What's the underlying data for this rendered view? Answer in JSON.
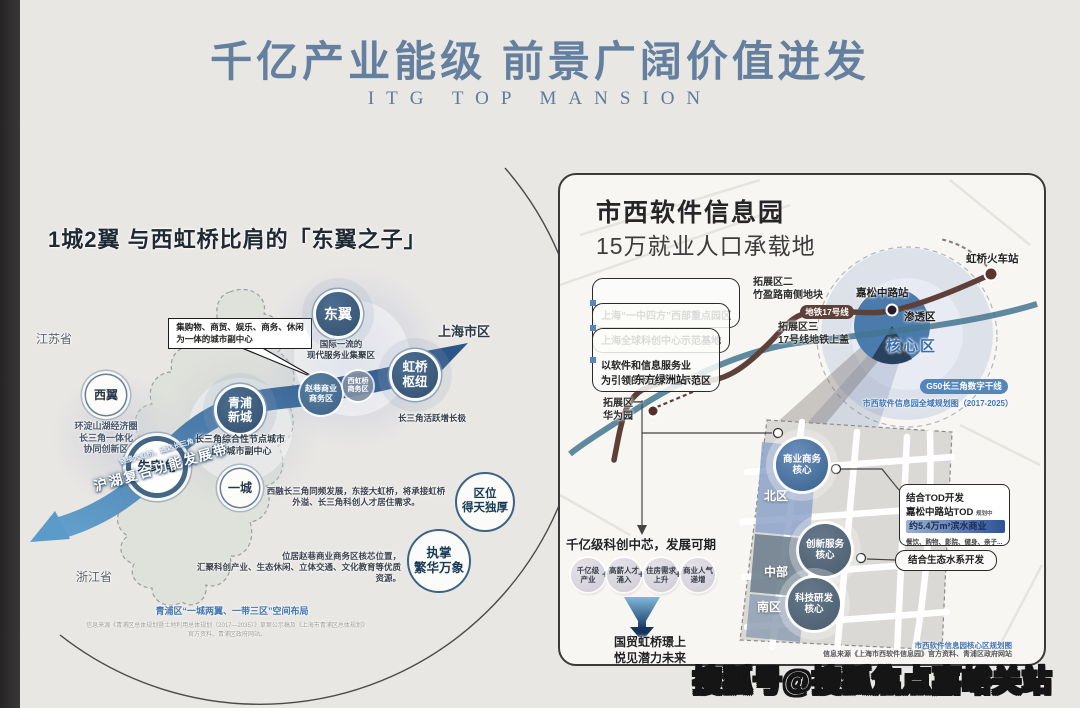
{
  "header": {
    "title": "千亿产业能级  前景广阔价值迸发",
    "subtitle": "ITG TOP MANSION"
  },
  "left_panel": {
    "title": "1城2翼 与西虹桥比肩的「东翼之子」",
    "jiangsu": "江苏省",
    "zhejiang": "浙江省",
    "shanghai": "上海市区",
    "callout": "集购物、商贸、娱乐、商务、休闲\n为一体的城市副中心",
    "west_wing": "西翼",
    "west_wing_desc": "环淀山湖经济圈\n长三角一体化\n协同创新区",
    "zhujiajiao": "朱家角",
    "qingpu": "青浦\n新城",
    "qingpu_desc": "长三角综合性节点城市\n上海城市副中心",
    "one_city": "一城",
    "east_wing": "东翼",
    "east_wing_desc": "国际一流的\n现代服务业集聚区",
    "zhaoxiang": "赵巷商业\n商务区",
    "west_hongqiao": "西虹桥\n商务区",
    "hongqiao_hub": "虹桥\n枢纽",
    "hongqiao_desc": "长三角活跃增长极",
    "ribbon_small": "链接大虹桥，通达长三角",
    "ribbon_label": "沪湖复合功能发展带",
    "desc1": "西融长三角同频发展，东接大虹桥，将承接虹桥\n外溢、长三角科创人才居住需求。",
    "desc2": "位居赵巷商业商务区核芯位置，\n汇聚科创产业、生态休闲、立体交通、文化教育等优质资源。",
    "badge_location": "区位\n得天独厚",
    "badge_prosperity": "执掌\n繁华万象",
    "caption": "青浦区“一城两翼、一带三区”空间布局",
    "source": "信息来源《青浦区总体规划暨土地利用总体规划（2017—2035）》草案公示稿及《上海市青浦区总体规划》\n官方资料、青浦区政府网站。"
  },
  "right_panel": {
    "title": "市西软件信息园",
    "subtitle": "15万就业人口承载地",
    "bullets": [
      "上海“一中四方”西部重点园区",
      "上海全球科创中心示范基地",
      "以软件和信息服务业\n为引领的科创产业示范区"
    ],
    "map": {
      "expansion2": "拓展区二\n竹盈路南侧地块",
      "metro_badge": "地铁17号线",
      "expansion3": "拓展区三\n17号线地铁上盖",
      "station_jiasong": "嘉松中路站",
      "zone_penetration": "渗透区",
      "zone_core": "核心区",
      "station_hongqiao": "虹桥火车站",
      "station_dongfang": "东方绿洲站",
      "expansion1": "拓展区一\n华为园",
      "g50_badge": "G50长三角数字干线",
      "plan_caption": "市西软件信息园全域规划图（2017-2025）",
      "district_north": "北区",
      "district_mid": "中部",
      "district_south": "南区",
      "core_business": "商业商务\n核心",
      "core_innovation": "创新服务\n核心",
      "core_tech": "科技研发\n核心",
      "tod_title": "结合TOD开发",
      "tod_line2": "嘉松中路站TOD",
      "tod_note": "规划中",
      "tod_highlight": "约5.4万m²滨水商业",
      "tod_desc": "餐饮、购物、影院、健身、亲子...",
      "eco_callout": "结合生态水系开发"
    },
    "bottom": {
      "headline": "千亿级科创中芯，发展可期",
      "factors": [
        "千亿级\n产业",
        "高薪人才\n涌入",
        "住房需求\n上升",
        "商业人气\n递增"
      ],
      "plus": "+",
      "conclusion": "国贸虹桥璟上\n悦见潜力未来"
    },
    "source_blue": "市西软件信息园核心区规划图",
    "source_gray": "信息来源《上海市西软件信息园》官方资料、青浦区政府网站"
  },
  "watermark": "搜狐号@搜狐焦点嘉峪关站"
}
